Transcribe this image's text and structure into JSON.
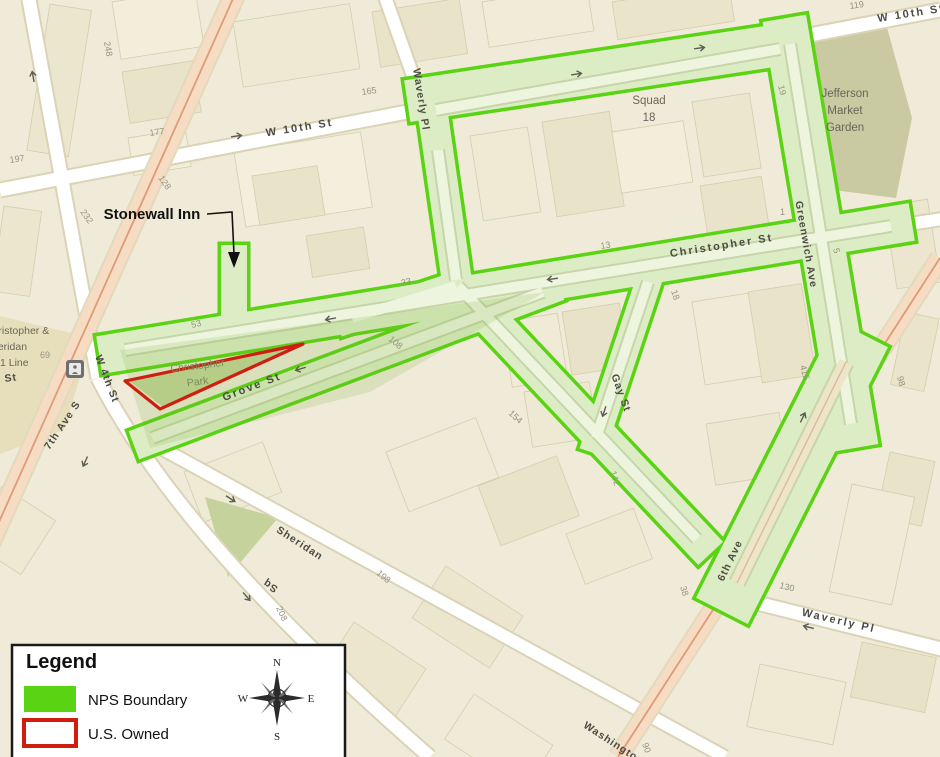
{
  "legend": {
    "title": "Legend",
    "items": [
      {
        "label": "NPS Boundary",
        "swatch": "nps-green-fill"
      },
      {
        "label": "U.S. Owned",
        "swatch": "red-outline"
      }
    ]
  },
  "compass": {
    "n": "N",
    "e": "E",
    "s": "S",
    "w": "W"
  },
  "annotation": {
    "stonewall": "Stonewall Inn"
  },
  "pois": {
    "squad": {
      "line1": "Squad",
      "line2": "18"
    },
    "jefferson": {
      "line1": "Jefferson",
      "line2": "Market",
      "line3": "Garden"
    },
    "christopher_park": {
      "line1": "Christopher",
      "line2": "Park"
    },
    "subway_station": {
      "line1": "Christopher &",
      "line2": "Sheridan",
      "line3": "1 Line"
    }
  },
  "streets": [
    {
      "text": "W 10th St"
    },
    {
      "text": "W 10th St"
    },
    {
      "text": "Waverly Pl"
    },
    {
      "text": "Waverly Pl"
    },
    {
      "text": "Christopher St"
    },
    {
      "text": "Greenwich Ave"
    },
    {
      "text": "Gay St"
    },
    {
      "text": "Grove St"
    },
    {
      "text": "7th Ave S"
    },
    {
      "text": "W 4th St"
    },
    {
      "text": "Sheridan"
    },
    {
      "text": "Sq"
    },
    {
      "text": "Washington"
    },
    {
      "text": "6th Ave"
    },
    {
      "text": "St"
    }
  ],
  "lot_numbers": [
    {
      "text": "248"
    },
    {
      "text": "177"
    },
    {
      "text": "197"
    },
    {
      "text": "232"
    },
    {
      "text": "128"
    },
    {
      "text": "165"
    },
    {
      "text": "53"
    },
    {
      "text": "33"
    },
    {
      "text": "13"
    },
    {
      "text": "119"
    },
    {
      "text": "19"
    },
    {
      "text": "1"
    },
    {
      "text": "5"
    },
    {
      "text": "415"
    },
    {
      "text": "98"
    },
    {
      "text": "108"
    },
    {
      "text": "154"
    },
    {
      "text": "142"
    },
    {
      "text": "18"
    },
    {
      "text": "38"
    },
    {
      "text": "130"
    },
    {
      "text": "90"
    },
    {
      "text": "69"
    },
    {
      "text": "198"
    },
    {
      "text": "208"
    }
  ],
  "colors": {
    "nps_boundary_green": "#5ad312",
    "nps_fill_green": "#dcedc6",
    "us_owned_red": "#cf1e10",
    "map_background": "#efebd8",
    "avenue_pink": "#f7dcc4"
  }
}
